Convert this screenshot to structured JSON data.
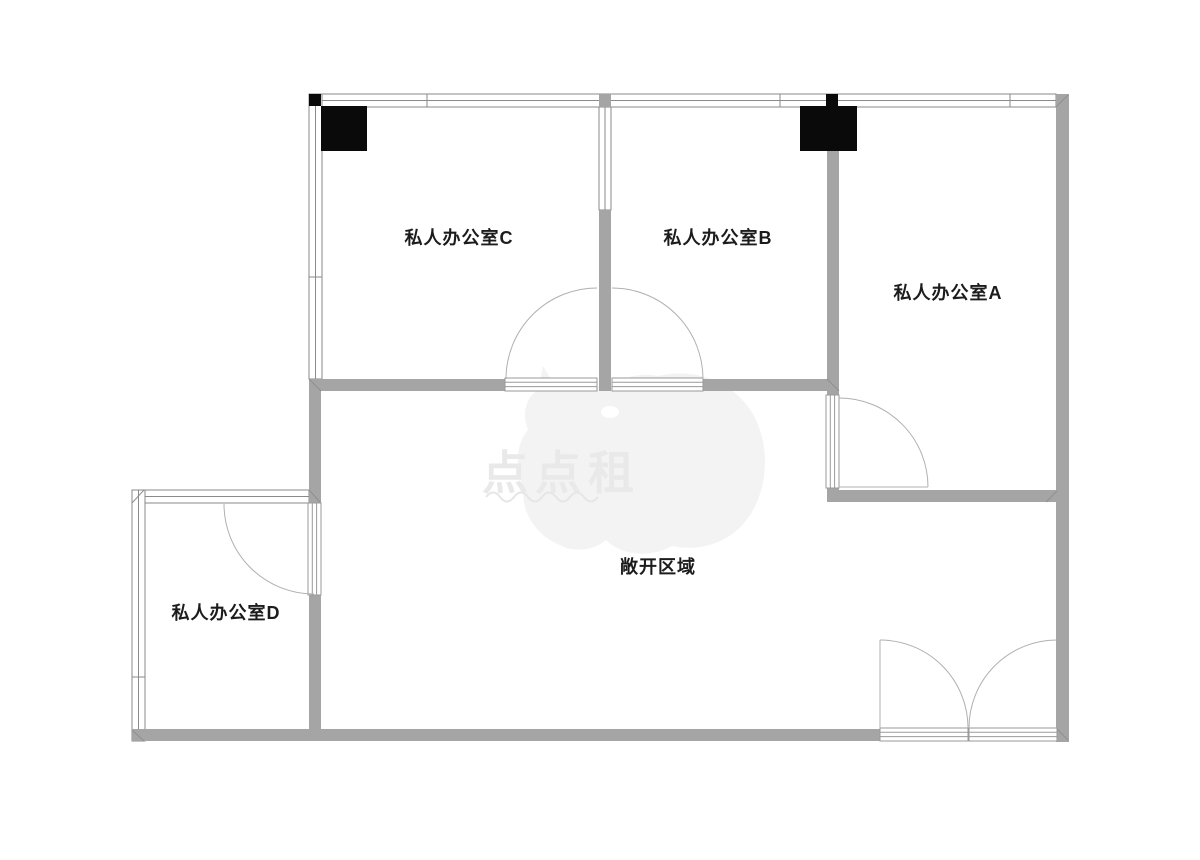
{
  "rooms": {
    "office_c": {
      "label": "私人办公室C"
    },
    "office_b": {
      "label": "私人办公室B"
    },
    "office_a": {
      "label": "私人办公室A"
    },
    "office_d": {
      "label": "私人办公室D"
    },
    "open_area": {
      "label": "敞开区域"
    }
  },
  "watermark": {
    "text": "点点租"
  },
  "colors": {
    "wall_solid": "#a5a5a5",
    "column": "#0a0a0a",
    "window_line": "#8a8a8a",
    "door_leaf_line": "#9a9a9a",
    "door_arc": "#b0b0b0",
    "label_text": "#1c1c1c",
    "watermark_shape": "#f3f3f3",
    "watermark_text": "#e9e9e9",
    "background": "#ffffff"
  }
}
